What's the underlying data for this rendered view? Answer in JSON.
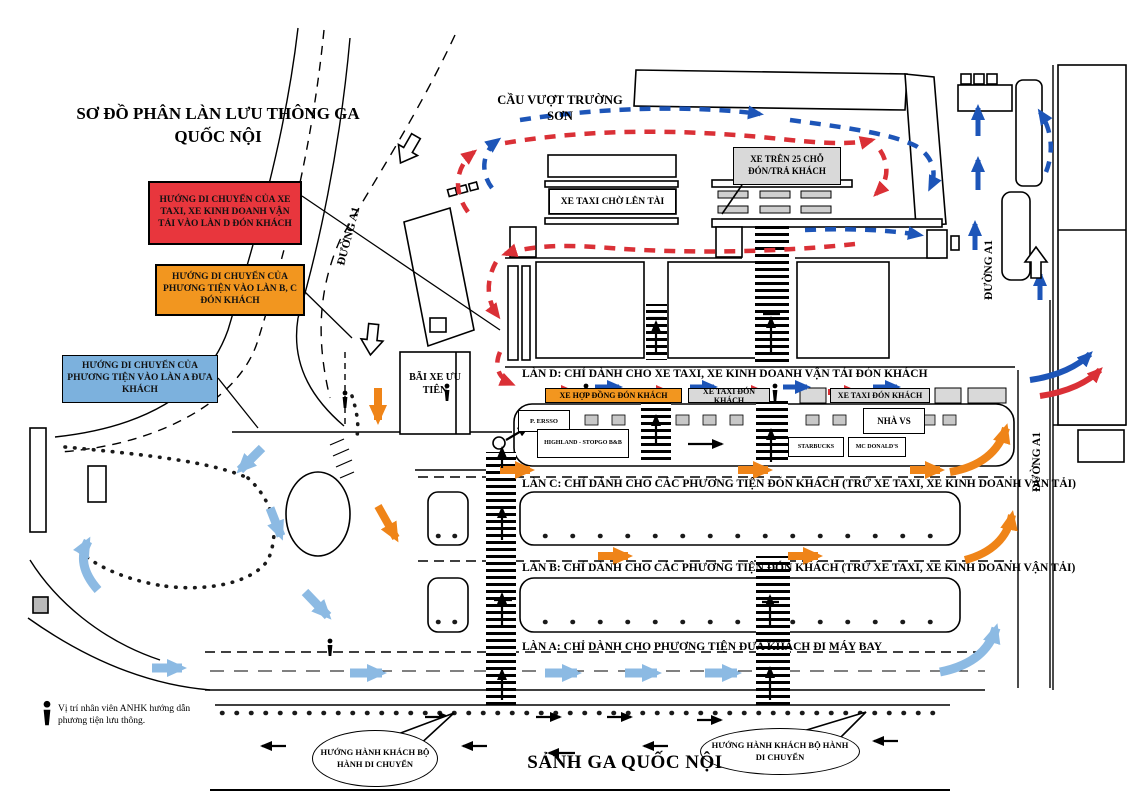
{
  "title": "SƠ ĐỒ PHÂN LÀN LƯU THÔNG GA QUỐC NỘI",
  "legend": {
    "red": {
      "text": "HƯỚNG DI CHUYỂN CỦA XE TAXI, XE KINH DOANH VẬN TẢI VÀO LÀN D ĐÓN KHÁCH",
      "color": "#e8363d"
    },
    "orange": {
      "text": "HƯỚNG DI CHUYỂN CỦA PHƯƠNG TIỆN VÀO LÀN B, C ĐÓN KHÁCH",
      "color": "#f2961f"
    },
    "blue": {
      "text": "HƯỚNG DI CHUYỂN CỦA PHƯƠNG TIỆN VÀO LÀN A ĐƯA KHÁCH",
      "color": "#7cb1dd"
    }
  },
  "labels": {
    "cau_vuot": "CẦU VƯỢT TRƯỜNG SƠN",
    "xe_tren_25": "XE TRÊN 25 CHỖ ĐÓN/TRẢ KHÁCH",
    "xe_taxi_cho": "XE TAXI CHỜ LÊN TÀI",
    "bai_xe": "BÃI XE ƯU TIÊN",
    "duong_a1_left": "ĐƯỜNG A1",
    "duong_a1_top_right": "ĐƯỜNG A1",
    "duong_a1_right": "ĐƯỜNG A1",
    "lane_d": "LÀN D: CHỈ DÀNH CHO XE TAXI, XE KINH DOANH VẬN TẢI ĐÓN KHÁCH",
    "lane_c": "LÀN C: CHỈ DÀNH CHO CÁC PHƯƠNG TIỆN ĐÓN KHÁCH (TRỪ XE TAXI, XE KINH DOANH VẬN TẢI)",
    "lane_b": "LÀN B: CHỈ DÀNH CHO CÁC PHƯƠNG TIỆN ĐÓN KHÁCH (TRỪ XE TAXI, XE KINH DOANH VẬN TẢI)",
    "lane_a": "LÀN A: CHỈ DÀNH CHO PHƯƠNG TIỆN ĐƯA KHÁCH ĐI MÁY BAY",
    "xe_hop_dong": "XE HỢP ĐỒNG ĐÓN KHÁCH",
    "xe_taxi_don_1": "XE TAXI ĐÓN KHÁCH",
    "xe_taxi_don_2": "XE TAXI ĐÓN KHÁCH",
    "p_ersso": "P. ERSSO",
    "highland": "HIGHLAND - STOPGO B&B",
    "nha_vs": "NHÀ VS",
    "starbucks": "STARBUCKS",
    "mcdonalds": "MC DONALD'S",
    "bubble_left": "HƯỚNG HÀNH KHÁCH BỘ HÀNH DI CHUYỂN",
    "bubble_right": "HƯỚNG HÀNH KHÁCH BỘ HÀNH DI CHUYỂN",
    "sanh_ga": "SẢNH GA QUỐC NỘI",
    "anhk_note": "Vị trí nhân viên ANHK hướng dẫn phương tiện lưu thông."
  },
  "colors": {
    "red_route": "#da3036",
    "blue_route": "#1d55b8",
    "orange_arrow": "#ef8418",
    "lightblue_arrow": "#8cbae3",
    "gray_fill": "#d9d9d9"
  }
}
